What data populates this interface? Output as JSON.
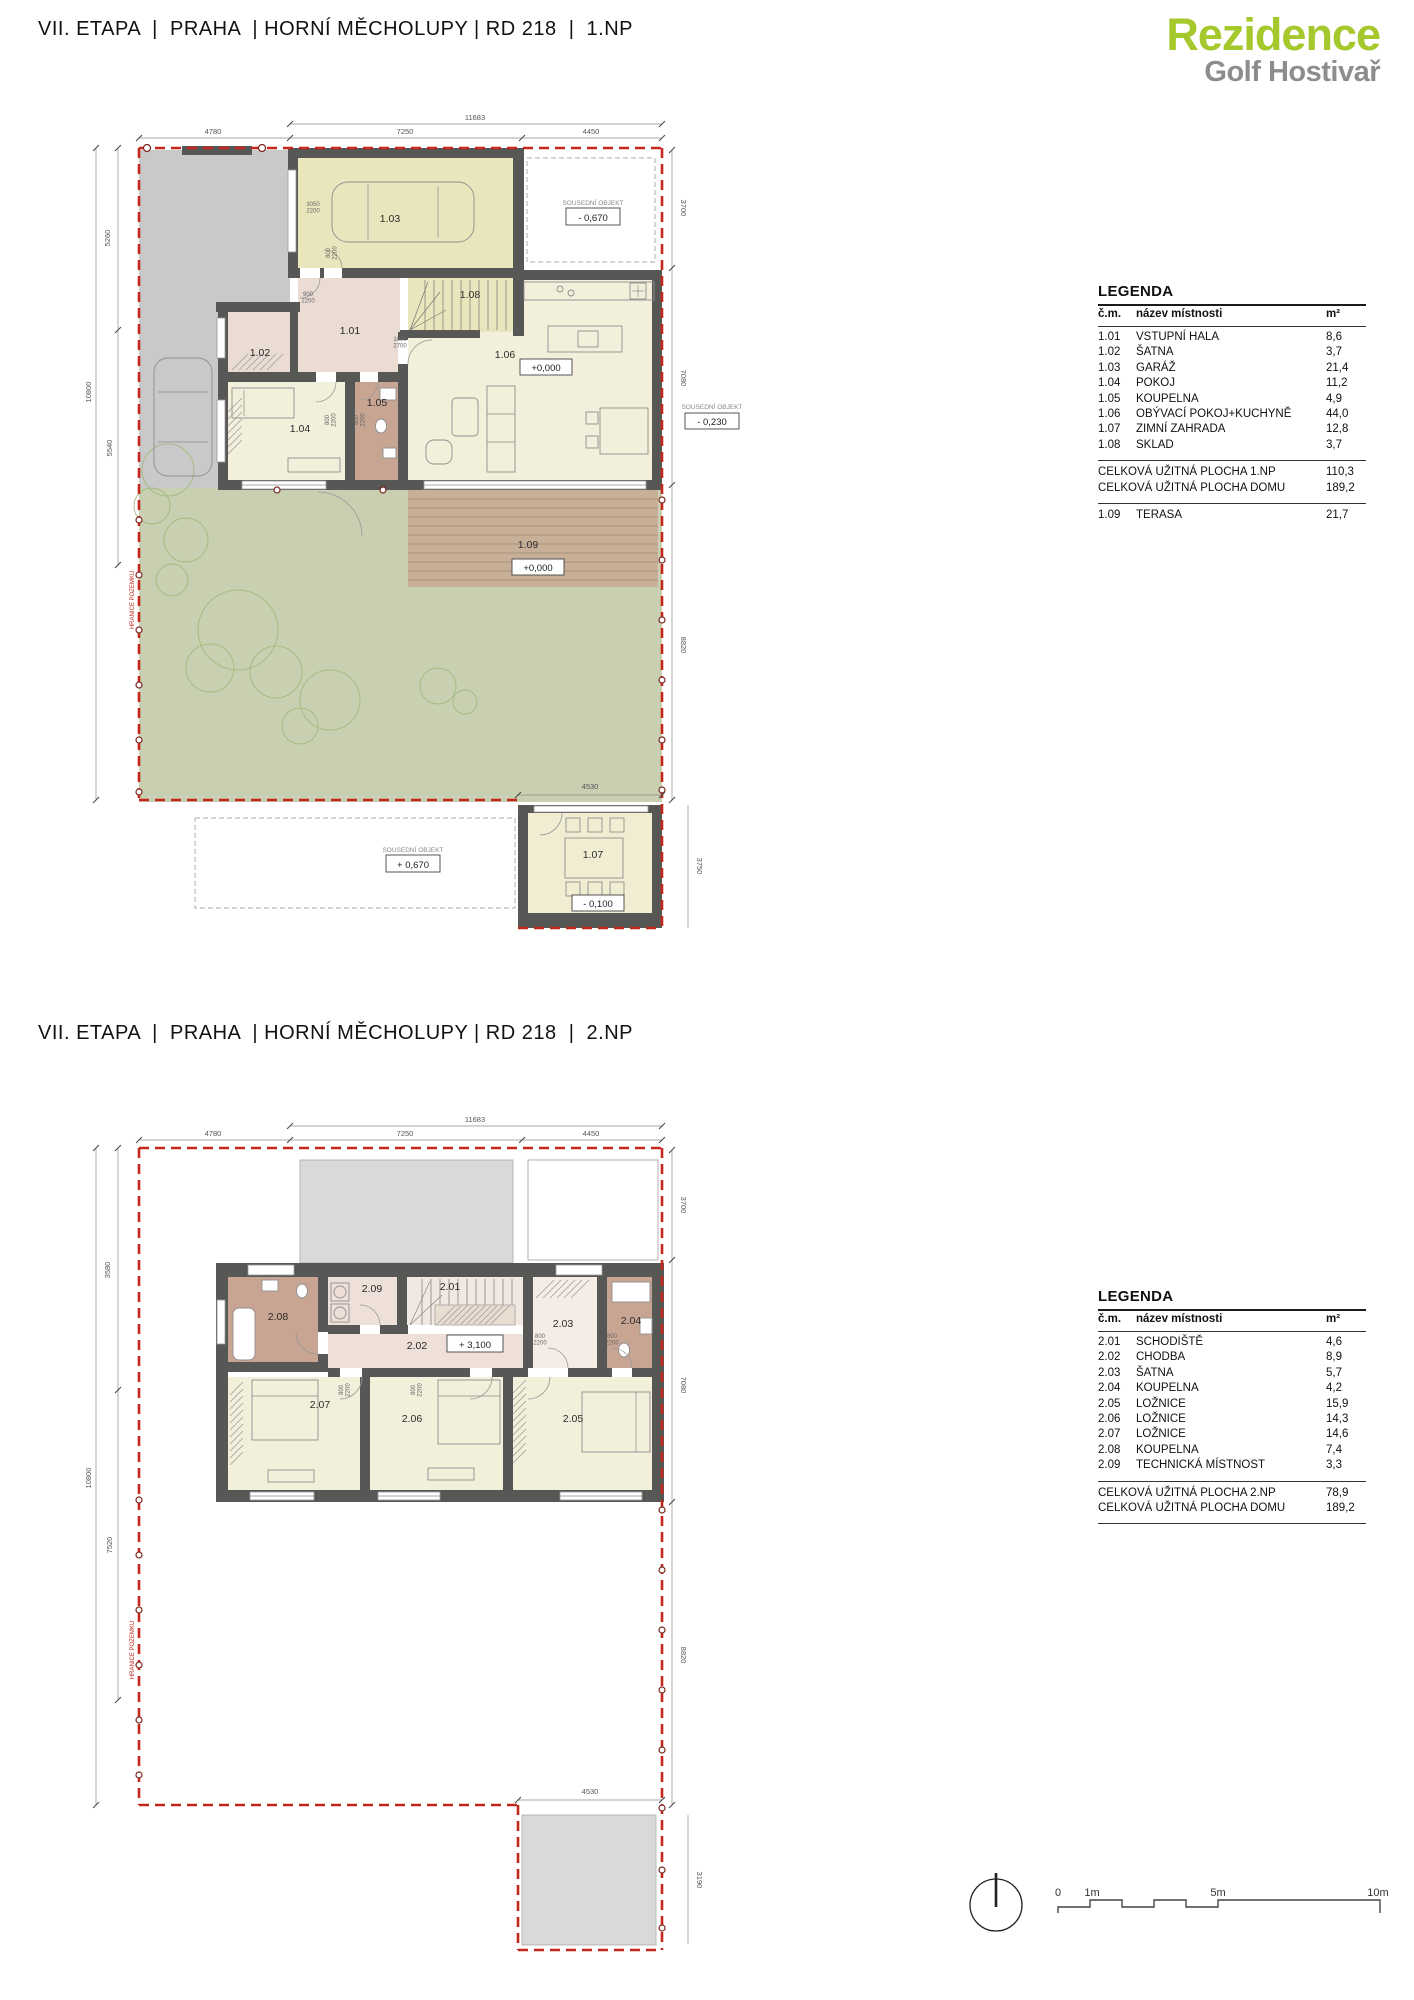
{
  "page": {
    "title_1np": "VII. ETAPA  |  PRAHA  | HORNÍ MĚCHOLUPY | RD 218  |  1.NP",
    "title_2np": "VII. ETAPA  |  PRAHA  | HORNÍ MĚCHOLUPY | RD 218  |  2.NP",
    "logo": {
      "line1": "Rezidence",
      "line2": "Golf Hostivař"
    }
  },
  "palette": {
    "brand_green": "#a5c82d",
    "brand_grey": "#8d8d8d",
    "wall": "#575756",
    "garage_yellow": "#e9e6bd",
    "room_cream": "#f2efda",
    "hall_pink": "#eadbd3",
    "bath_brown": "#c8a593",
    "garden_green": "#c9d0b2",
    "paving_grey": "#c9c9c9",
    "terrace_wood": "#c8b098",
    "boundary_red": "#c3281c",
    "roof_grey": "#d9d9d9"
  },
  "legend_1np": {
    "heading": "LEGENDA",
    "columns": {
      "num": "č.m.",
      "name": "název místnosti",
      "area": "m²"
    },
    "rows": [
      {
        "num": "1.01",
        "name": "VSTUPNÍ HALA",
        "area": "8,6"
      },
      {
        "num": "1.02",
        "name": "ŠATNA",
        "area": "3,7"
      },
      {
        "num": "1.03",
        "name": "GARÁŽ",
        "area": "21,4"
      },
      {
        "num": "1.04",
        "name": "POKOJ",
        "area": "11,2"
      },
      {
        "num": "1.05",
        "name": "KOUPELNA",
        "area": "4,9"
      },
      {
        "num": "1.06",
        "name": "OBÝVACÍ POKOJ+KUCHYNĚ",
        "area": "44,0"
      },
      {
        "num": "1.07",
        "name": "ZIMNÍ ZAHRADA",
        "area": "12,8"
      },
      {
        "num": "1.08",
        "name": "SKLAD",
        "area": "3,7"
      }
    ],
    "totals": [
      {
        "label": "CELKOVÁ UŽITNÁ PLOCHA 1.NP",
        "value": "110,3"
      },
      {
        "label": "CELKOVÁ UŽITNÁ PLOCHA DOMU",
        "value": "189,2"
      }
    ],
    "extra": {
      "num": "1.09",
      "name": "TERASA",
      "area": "21,7"
    }
  },
  "legend_2np": {
    "heading": "LEGENDA",
    "columns": {
      "num": "č.m.",
      "name": "název místnosti",
      "area": "m²"
    },
    "rows": [
      {
        "num": "2.01",
        "name": "SCHODIŠTĚ",
        "area": "4,6"
      },
      {
        "num": "2.02",
        "name": "CHODBA",
        "area": "8,9"
      },
      {
        "num": "2.03",
        "name": "ŠATNA",
        "area": "5,7"
      },
      {
        "num": "2.04",
        "name": "KOUPELNA",
        "area": "4,2"
      },
      {
        "num": "2.05",
        "name": "LOŽNICE",
        "area": "15,9"
      },
      {
        "num": "2.06",
        "name": "LOŽNICE",
        "area": "14,3"
      },
      {
        "num": "2.07",
        "name": "LOŽNICE",
        "area": "14,6"
      },
      {
        "num": "2.08",
        "name": "KOUPELNA",
        "area": "7,4"
      },
      {
        "num": "2.09",
        "name": "TECHNICKÁ MÍSTNOST",
        "area": "3,3"
      }
    ],
    "totals": [
      {
        "label": "CELKOVÁ UŽITNÁ PLOCHA 2.NP",
        "value": "78,9"
      },
      {
        "label": "CELKOVÁ UŽITNÁ PLOCHA DOMU",
        "value": "189,2"
      }
    ]
  },
  "plan_1np": {
    "room_labels": [
      {
        "t": "1.01",
        "x": 350,
        "y": 334
      },
      {
        "t": "1.02",
        "x": 260,
        "y": 356
      },
      {
        "t": "1.03",
        "x": 390,
        "y": 222
      },
      {
        "t": "1.04",
        "x": 300,
        "y": 432
      },
      {
        "t": "1.05",
        "x": 377,
        "y": 406
      },
      {
        "t": "1.06",
        "x": 505,
        "y": 358
      },
      {
        "t": "1.07",
        "x": 593,
        "y": 858
      },
      {
        "t": "1.08",
        "x": 470,
        "y": 298
      },
      {
        "t": "1.09",
        "x": 528,
        "y": 548
      }
    ],
    "level_boxes": [
      {
        "t": "+0,000",
        "x": 546,
        "y": 371,
        "b": 1,
        "bw": 52,
        "bh": 16
      },
      {
        "t": "+0,000",
        "x": 538,
        "y": 571,
        "b": 1,
        "bw": 52,
        "bh": 16
      },
      {
        "t": "- 0,670",
        "x": 593,
        "y": 221,
        "b": 1,
        "bw": 54,
        "bh": 17
      },
      {
        "t": "- 0,230",
        "x": 712,
        "y": 425,
        "b": 1,
        "bw": 54,
        "bh": 16
      },
      {
        "t": "+ 0,670",
        "x": 413,
        "y": 868,
        "b": 1,
        "bw": 54,
        "bh": 17
      },
      {
        "t": "- 0,100",
        "x": 598,
        "y": 907,
        "b": 1,
        "bw": 52,
        "bh": 16
      }
    ],
    "neighbor_labels": [
      {
        "t": "SOUSEDNÍ OBJEKT",
        "x": 593,
        "y": 205
      },
      {
        "t": "SOUSEDNÍ OBJEKT",
        "x": 712,
        "y": 409
      },
      {
        "t": "SOUSEDNÍ OBJEKT",
        "x": 413,
        "y": 852
      }
    ],
    "dim_labels": [
      {
        "t": "11683",
        "x": 475,
        "y": 120
      },
      {
        "t": "4780",
        "x": 213,
        "y": 134
      },
      {
        "t": "7250",
        "x": 405,
        "y": 134
      },
      {
        "t": "4450",
        "x": 591,
        "y": 134
      },
      {
        "t": "5260",
        "x": 110,
        "y": 238,
        "r": -90
      },
      {
        "t": "10800",
        "x": 91,
        "y": 392,
        "r": -90
      },
      {
        "t": "5540",
        "x": 112,
        "y": 448,
        "r": -90
      },
      {
        "t": "3700",
        "x": 681,
        "y": 208,
        "r": 90
      },
      {
        "t": "7080",
        "x": 681,
        "y": 378,
        "r": 90
      },
      {
        "t": "8820",
        "x": 681,
        "y": 645,
        "r": 90
      },
      {
        "t": "3750",
        "x": 697,
        "y": 866,
        "r": 90
      },
      {
        "t": "4530",
        "x": 590,
        "y": 789
      }
    ],
    "door_labels": [
      {
        "t": "3050",
        "t2": "2200",
        "x": 313,
        "y": 206
      },
      {
        "t": "900",
        "t2": "2200",
        "x": 308,
        "y": 296
      },
      {
        "t": "1000",
        "t2": "2700",
        "x": 400,
        "y": 341
      },
      {
        "t": "800",
        "t2": "2200",
        "x": 330,
        "y": 253,
        "r": -90
      },
      {
        "t": "800",
        "t2": "2200",
        "x": 329,
        "y": 420,
        "r": -90
      },
      {
        "t": "800",
        "t2": "2200",
        "x": 358,
        "y": 420,
        "r": -90
      }
    ],
    "boundary_labels": [
      {
        "t": "HRANICE POZEMKU",
        "x": 134,
        "y": 600,
        "r": -90
      }
    ]
  },
  "plan_2np": {
    "room_labels": [
      {
        "t": "2.01",
        "x": 450,
        "y": 1290
      },
      {
        "t": "2.02",
        "x": 417,
        "y": 1349
      },
      {
        "t": "2.03",
        "x": 563,
        "y": 1327
      },
      {
        "t": "2.04",
        "x": 631,
        "y": 1324
      },
      {
        "t": "2.05",
        "x": 573,
        "y": 1422
      },
      {
        "t": "2.06",
        "x": 412,
        "y": 1422
      },
      {
        "t": "2.07",
        "x": 320,
        "y": 1408
      },
      {
        "t": "2.08",
        "x": 278,
        "y": 1320
      },
      {
        "t": "2.09",
        "x": 372,
        "y": 1292
      }
    ],
    "level_boxes": [
      {
        "t": "+ 3,100",
        "x": 475,
        "y": 1348,
        "b": 1,
        "bw": 56,
        "bh": 17
      }
    ],
    "dim_labels": [
      {
        "t": "11683",
        "x": 475,
        "y": 1122
      },
      {
        "t": "4780",
        "x": 213,
        "y": 1136
      },
      {
        "t": "7250",
        "x": 405,
        "y": 1136
      },
      {
        "t": "4450",
        "x": 591,
        "y": 1136
      },
      {
        "t": "3580",
        "x": 110,
        "y": 1270,
        "r": -90
      },
      {
        "t": "10800",
        "x": 91,
        "y": 1478,
        "r": -90
      },
      {
        "t": "7520",
        "x": 112,
        "y": 1545,
        "r": -90
      },
      {
        "t": "3700",
        "x": 681,
        "y": 1205,
        "r": 90
      },
      {
        "t": "7080",
        "x": 681,
        "y": 1385,
        "r": 90
      },
      {
        "t": "8820",
        "x": 681,
        "y": 1655,
        "r": 90
      },
      {
        "t": "3190",
        "x": 697,
        "y": 1880,
        "r": 90
      },
      {
        "t": "4530",
        "x": 590,
        "y": 1794
      }
    ],
    "door_labels": [
      {
        "t": "800",
        "t2": "2200",
        "x": 343,
        "y": 1390,
        "r": -90
      },
      {
        "t": "800",
        "t2": "2200",
        "x": 415,
        "y": 1390,
        "r": -90
      },
      {
        "t": "800",
        "t2": "2200",
        "x": 540,
        "y": 1338
      },
      {
        "t": "800",
        "t2": "2200",
        "x": 612,
        "y": 1338
      }
    ],
    "boundary_labels": [
      {
        "t": "HRANICE POZEMKU",
        "x": 134,
        "y": 1650,
        "r": -90
      }
    ]
  },
  "scale_bar": {
    "labels": [
      {
        "t": "0",
        "x": 1058,
        "y": 1896
      },
      {
        "t": "1m",
        "x": 1092,
        "y": 1896
      },
      {
        "t": "5m",
        "x": 1218,
        "y": 1896
      },
      {
        "t": "10m",
        "x": 1378,
        "y": 1896
      }
    ]
  }
}
